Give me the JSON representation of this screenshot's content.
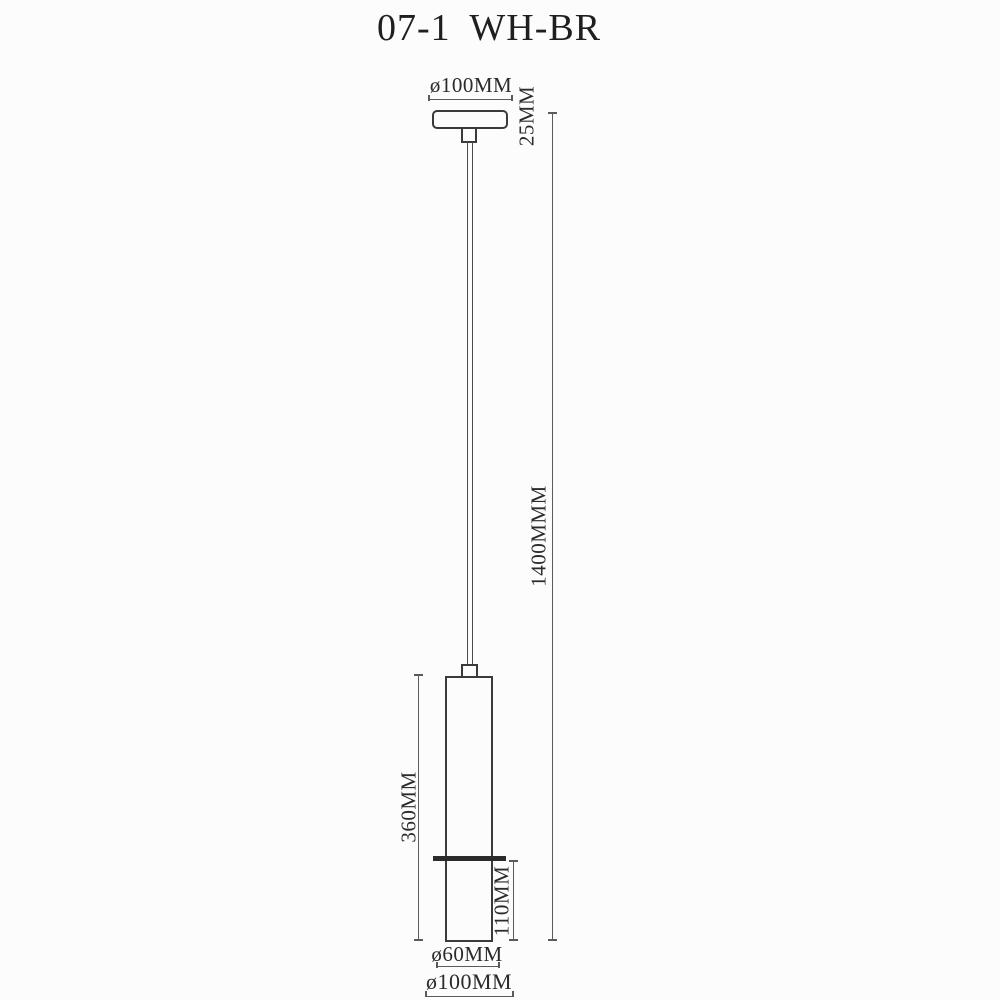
{
  "title": "07-1 WH-BR",
  "colors": {
    "background": "#fcfcfc",
    "outline": "#3a3a3a",
    "dim_line": "#5a5a5a",
    "band": "#2b2b2b",
    "text": "#2b2b2b"
  },
  "labels": {
    "canopy_diameter": "ø100MM",
    "canopy_height": "25MM",
    "suspension_length": "1400MMM",
    "body_height": "360MM",
    "lower_section_height": "110MM",
    "shade_diameter": "ø60MM",
    "overall_bottom_diameter": "ø100MM"
  }
}
